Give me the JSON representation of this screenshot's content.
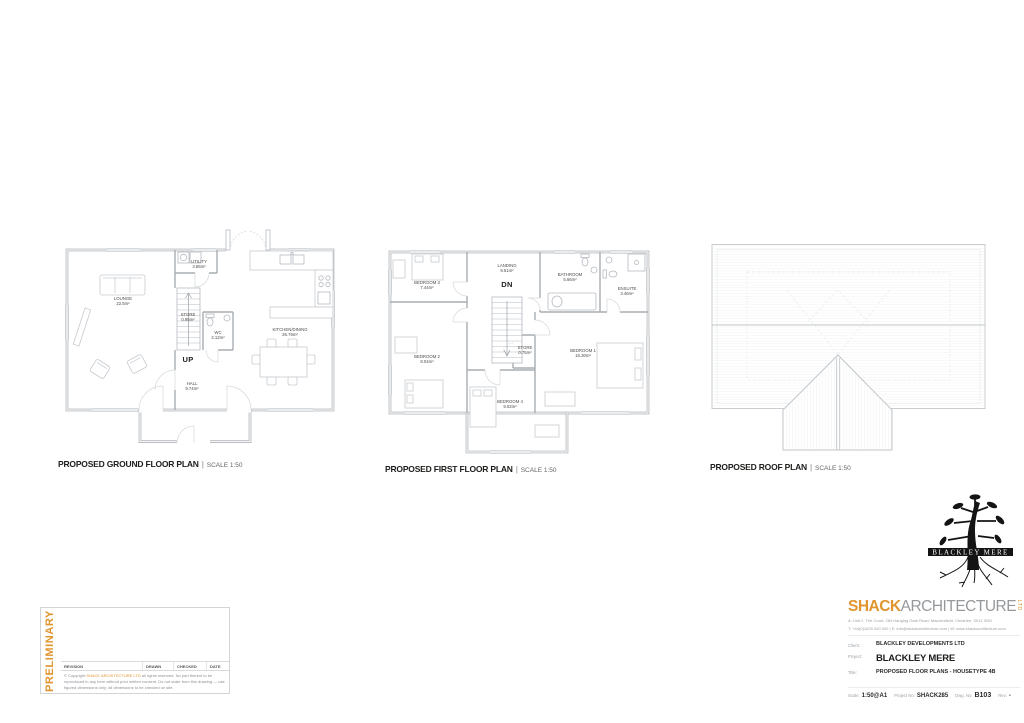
{
  "sheet": {
    "accent": "#E0952F",
    "title_separator": "|"
  },
  "plans": {
    "ground": {
      "title": "PROPOSED GROUND FLOOR PLAN",
      "scale_note": "SCALE 1:50",
      "stair_label": "UP",
      "rooms": {
        "lounge": {
          "name": "LOUNGE",
          "area": "22.5m²"
        },
        "utility": {
          "name": "UTILITY",
          "area": "3.86m²"
        },
        "store": {
          "name": "STORE",
          "area": "0.95m²"
        },
        "wc": {
          "name": "WC",
          "area": "2.12m²"
        },
        "kitchen": {
          "name": "KITCHEN/DINING",
          "area": "26.76m²"
        },
        "hall": {
          "name": "HALL",
          "area": "9.74m²"
        }
      }
    },
    "first": {
      "title": "PROPOSED FIRST FLOOR PLAN",
      "scale_note": "SCALE 1:50",
      "stair_label": "DN",
      "rooms": {
        "landing": {
          "name": "LANDING",
          "area": "9.51m²"
        },
        "bedroom3": {
          "name": "BEDROOM 3",
          "area": "7.44m²"
        },
        "bathroom": {
          "name": "BATHROOM",
          "area": "5.66m²"
        },
        "ensuite": {
          "name": "ENSUITE",
          "area": "3.46m²"
        },
        "bedroom2": {
          "name": "BEDROOM 2",
          "area": "8.04m²"
        },
        "store": {
          "name": "STORE",
          "area": "0.75m²"
        },
        "bedroom1": {
          "name": "BEDROOM 1",
          "area": "15.30m²"
        },
        "bedroom4": {
          "name": "BEDROOM 4",
          "area": "9.02m²"
        }
      }
    },
    "roof": {
      "title": "PROPOSED ROOF PLAN",
      "scale_note": "SCALE 1:50"
    }
  },
  "logo": {
    "name": "BLACKLEY MERE"
  },
  "preliminary": {
    "watermark": "PRELIMINARY",
    "rev_headers": [
      "REVISION",
      "DRAWN",
      "CHECKED",
      "DATE"
    ],
    "copyright_prefix": "© Copyright ",
    "copyright_firm": "SHACK ARCHITECTURE LTD",
    "copyright_body": " all rights reserved. No part thereof to be reproduced in any form without prior written consent. Do not scale from this drawing — use figured dimensions only; all dimensions to be checked on site."
  },
  "titleblock": {
    "firm_accent": "SHACK",
    "firm_rest": "ARCHITECTURE",
    "firm_suffix": "LTD",
    "address": "A: Unit 2, The Court, 284 Hanging Gate Road, Macclesfield, Cheshire, SK11 0NG",
    "contact": "T: +44(0)1625 000 000 | E: info@shackarchitecture.com | W: www.shackarchitecture.com",
    "rows": [
      {
        "label": "Client:",
        "value": "BLACKLEY DEVELOPMENTS LTD"
      },
      {
        "label": "Project:",
        "value": "BLACKLEY MERE"
      },
      {
        "label": "Title:",
        "value": "PROPOSED FLOOR PLANS - HOUSETYPE 4B"
      }
    ],
    "meta": [
      {
        "label": "Scale:",
        "value": "1:50@A1"
      },
      {
        "label": "Project No:",
        "value": "SHACK285"
      },
      {
        "label": "Dwg. No:",
        "value": "B103"
      },
      {
        "label": "Rev:",
        "value": "-"
      }
    ]
  }
}
